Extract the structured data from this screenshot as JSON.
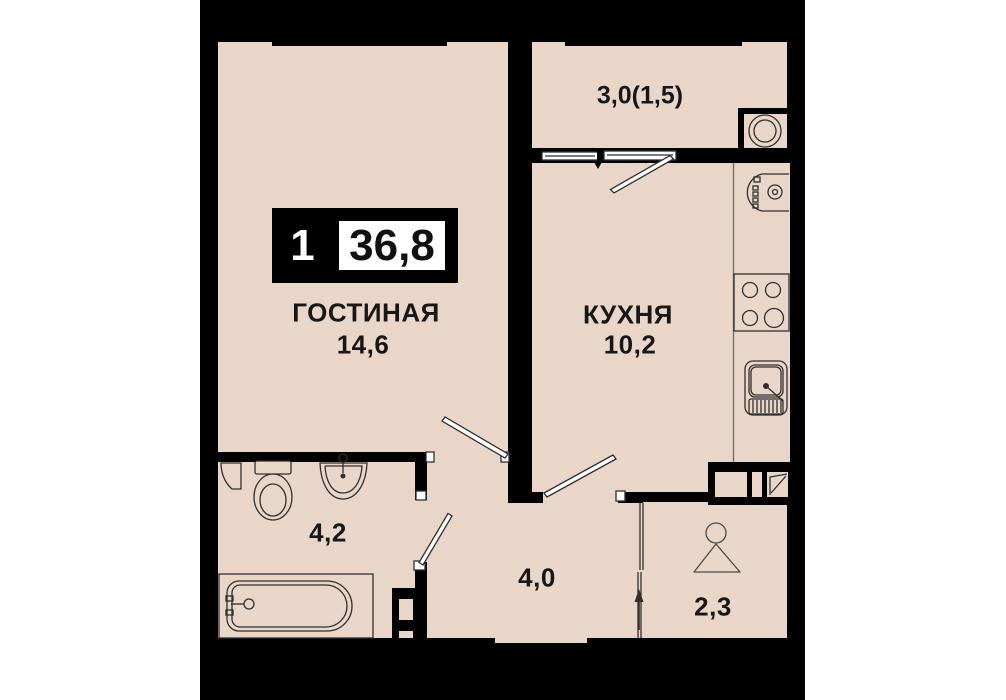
{
  "plan": {
    "title": "apartment-floorplan",
    "badge": {
      "rooms": "1",
      "total_area": "36,8"
    },
    "rooms": {
      "living": {
        "name": "ГОСТИНАЯ",
        "area": "14,6"
      },
      "kitchen": {
        "name": "КУХНЯ",
        "area": "10,2"
      },
      "balcony": {
        "area": "3,0(1,5)"
      },
      "bathroom": {
        "area": "4,2"
      },
      "hallway": {
        "area": "4,0"
      },
      "wardrobe": {
        "area": "2,3"
      }
    },
    "fixtures": [
      "washing-machine-icon",
      "oven-icon",
      "stove-icon",
      "kitchen-sink-icon",
      "toilet-icon",
      "washbasin-icon",
      "bathtub-icon",
      "hanger-icon",
      "entrance-arrow-icon",
      "duct-shaft-icon",
      "balcony-window-icon"
    ],
    "colors": {
      "floor": "#e9d6c9",
      "wall": "#000000",
      "text": "#171717",
      "fixture_line": "#2f2f2f",
      "paper": "#ffffff"
    }
  }
}
